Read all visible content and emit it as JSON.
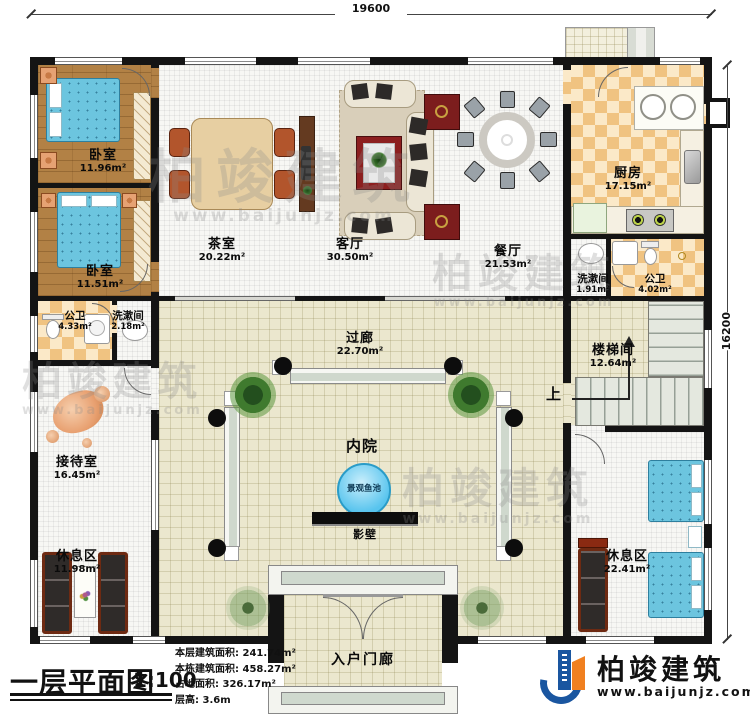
{
  "plan": {
    "title": "一层平面图",
    "scale": "1:100",
    "stats": [
      {
        "label": "本层建筑面积:",
        "value": "241.74m²"
      },
      {
        "label": "本栋建筑面积:",
        "value": "458.27m²"
      },
      {
        "label": "占地面积:",
        "value": "326.17m²"
      },
      {
        "label": "层高:",
        "value": "3.6m"
      }
    ]
  },
  "dimensions": {
    "top": "19600",
    "right": "16200"
  },
  "rooms": {
    "bedroom_1": {
      "name": "卧室",
      "area": "11.96m²"
    },
    "bedroom_2": {
      "name": "卧室",
      "area": "11.51m²"
    },
    "tea_room": {
      "name": "茶室",
      "area": "20.22m²"
    },
    "living_room": {
      "name": "客厅",
      "area": "30.50m²"
    },
    "dining_room": {
      "name": "餐厅",
      "area": "21.53m²"
    },
    "kitchen": {
      "name": "厨房",
      "area": "17.15m²"
    },
    "washroom_right": {
      "name": "洗漱间",
      "area": "1.91m²"
    },
    "toilet_right": {
      "name": "公卫",
      "area": "4.02m²"
    },
    "stair_hall": {
      "name": "楼梯间",
      "area": "12.64m²"
    },
    "toilet_left": {
      "name": "公卫",
      "area": "4.33m²"
    },
    "washroom_left": {
      "name": "洗漱间",
      "area": "2.18m²"
    },
    "corridor": {
      "name": "过廊",
      "area": "22.70m²"
    },
    "reception": {
      "name": "接待室",
      "area": "16.45m²"
    },
    "lounge_left": {
      "name": "休息区",
      "area": "11.98m²"
    },
    "lounge_right": {
      "name": "休息区",
      "area": "22.41m²"
    },
    "courtyard": {
      "name": "内院"
    },
    "fish_pond": {
      "name": "景观鱼池"
    },
    "screen_wall": {
      "name": "影壁"
    },
    "entry_porch": {
      "name": "入户门廊"
    },
    "stairs_up": "上"
  },
  "brand": {
    "name": "柏竣建筑",
    "url": "www.baijunjz.com"
  },
  "watermark": {
    "text": "柏竣建筑",
    "url": "www.baijunjz.com"
  },
  "colors": {
    "wall": "#141414",
    "wood_floor": "#b28145",
    "checker_tile": "#f0c381",
    "corridor_floor": "#ebe7ce",
    "bed": "#6cc5df",
    "pond": "#58c4ee",
    "brand_blue": "#1a56a0",
    "brand_orange": "#f08020"
  }
}
